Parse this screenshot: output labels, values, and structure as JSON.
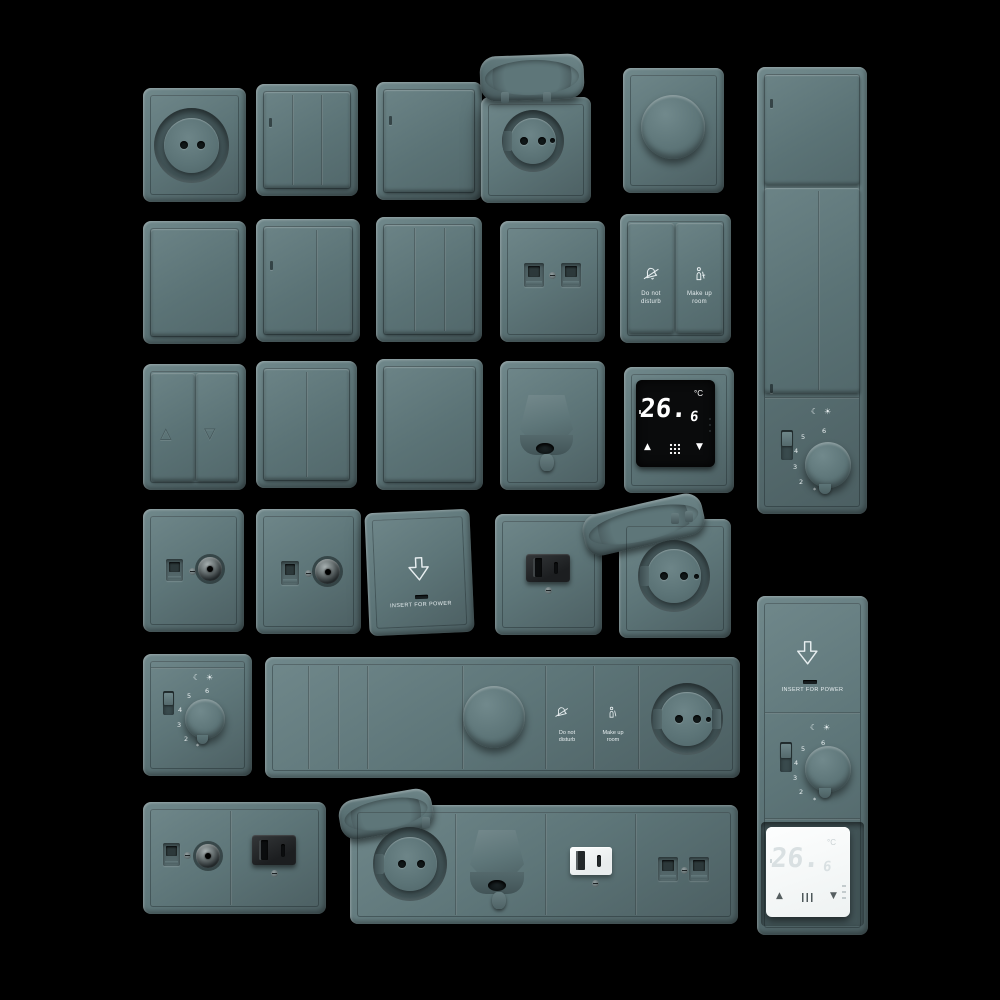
{
  "colors": {
    "background": "#000000",
    "plate": "#5d7578",
    "plate_light": "#70888b",
    "plate_dark": "#4b5e61",
    "label_ink": "#e7eef0",
    "engraved_ink": "#46595c",
    "screen_black": "#0a0b0c",
    "screen_digits": "#ffffff",
    "device_white": "#eef2f2",
    "module_black": "#1c1e20"
  },
  "labels": {
    "insert_for_power": "INSERT FOR POWER",
    "do_not_disturb": [
      "Do not",
      "disturb"
    ],
    "make_up_room": [
      "Make up",
      "room"
    ]
  },
  "thermostat": {
    "value": "26.",
    "decimal": "6",
    "unit": "°C",
    "up_arrow": "▲",
    "down_arrow": "▼"
  },
  "dial": {
    "numbers": [
      "6",
      "5",
      "4",
      "3",
      "2"
    ],
    "frost_mark": "*",
    "night_icon": "☾",
    "day_icon": "☀"
  },
  "curtain_switch": {
    "up_arrow": "△",
    "down_arrow": "▽"
  }
}
